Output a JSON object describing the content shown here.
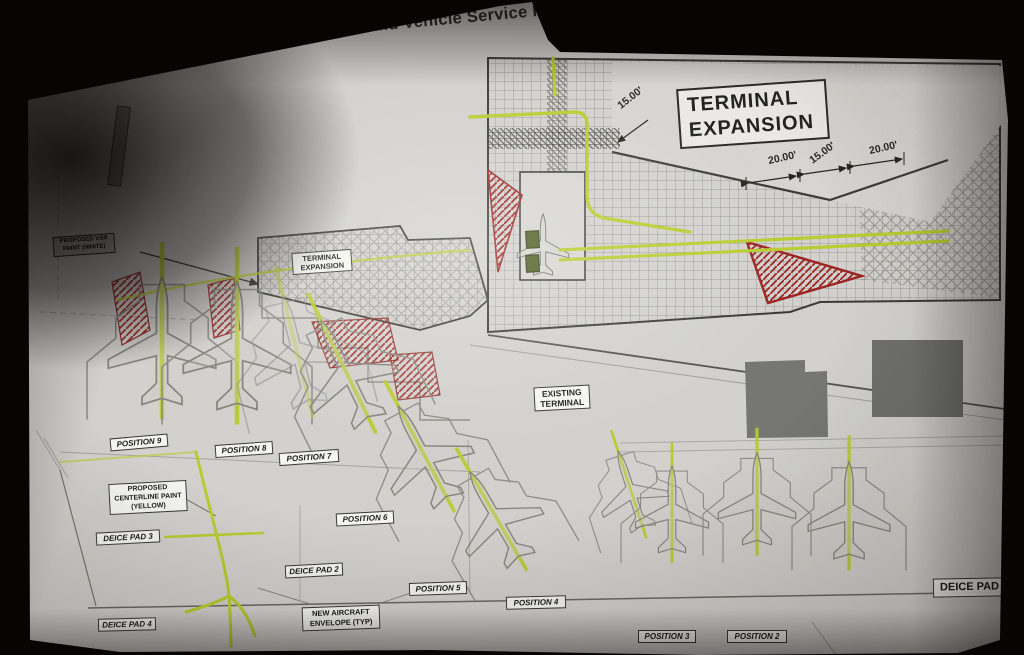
{
  "slide": {
    "script_title": "Design Update",
    "separator": "|",
    "main_title": "FINAL Apron and Vehicle Service Road"
  },
  "plan": {
    "terminal_expansion_big": {
      "line1": "TERMINAL",
      "line2": "EXPANSION"
    },
    "terminal_expansion_small": {
      "line1": "TERMINAL",
      "line2": "EXPANSION"
    },
    "existing_terminal": {
      "line1": "EXISTING",
      "line2": "TERMINAL"
    },
    "dimensions": {
      "d1": "15.00'",
      "d2": "20.00'",
      "d3": "15.00'",
      "d4": "20.00'"
    },
    "positions": [
      "POSITION 9",
      "POSITION 8",
      "POSITION 7",
      "POSITION 6",
      "POSITION 5",
      "POSITION 4",
      "POSITION 3",
      "POSITION 2"
    ],
    "deice_pad_3": "DEICE PAD 3",
    "deice_pad_2": "DEICE PAD 2",
    "deice_pad_4": "DEICE PAD 4",
    "deice_pad_1": "DEICE PAD",
    "notes": {
      "centerline": {
        "line1": "PROPOSED",
        "line2": "CENTERLINE PAINT",
        "line3": "(YELLOW)"
      },
      "envelope": {
        "line1": "NEW AIRCRAFT",
        "line2": "ENVELOPE (TYP)"
      },
      "vsr": {
        "line1": "PROPOSED VSR",
        "line2": "PAINT (WHITE)"
      }
    }
  },
  "colors": {
    "centerline_yellow": "#b9cc31",
    "hatch_red": "#9c2422",
    "screen_bg": "#d2d1cd",
    "ink": "#3c3c37"
  }
}
